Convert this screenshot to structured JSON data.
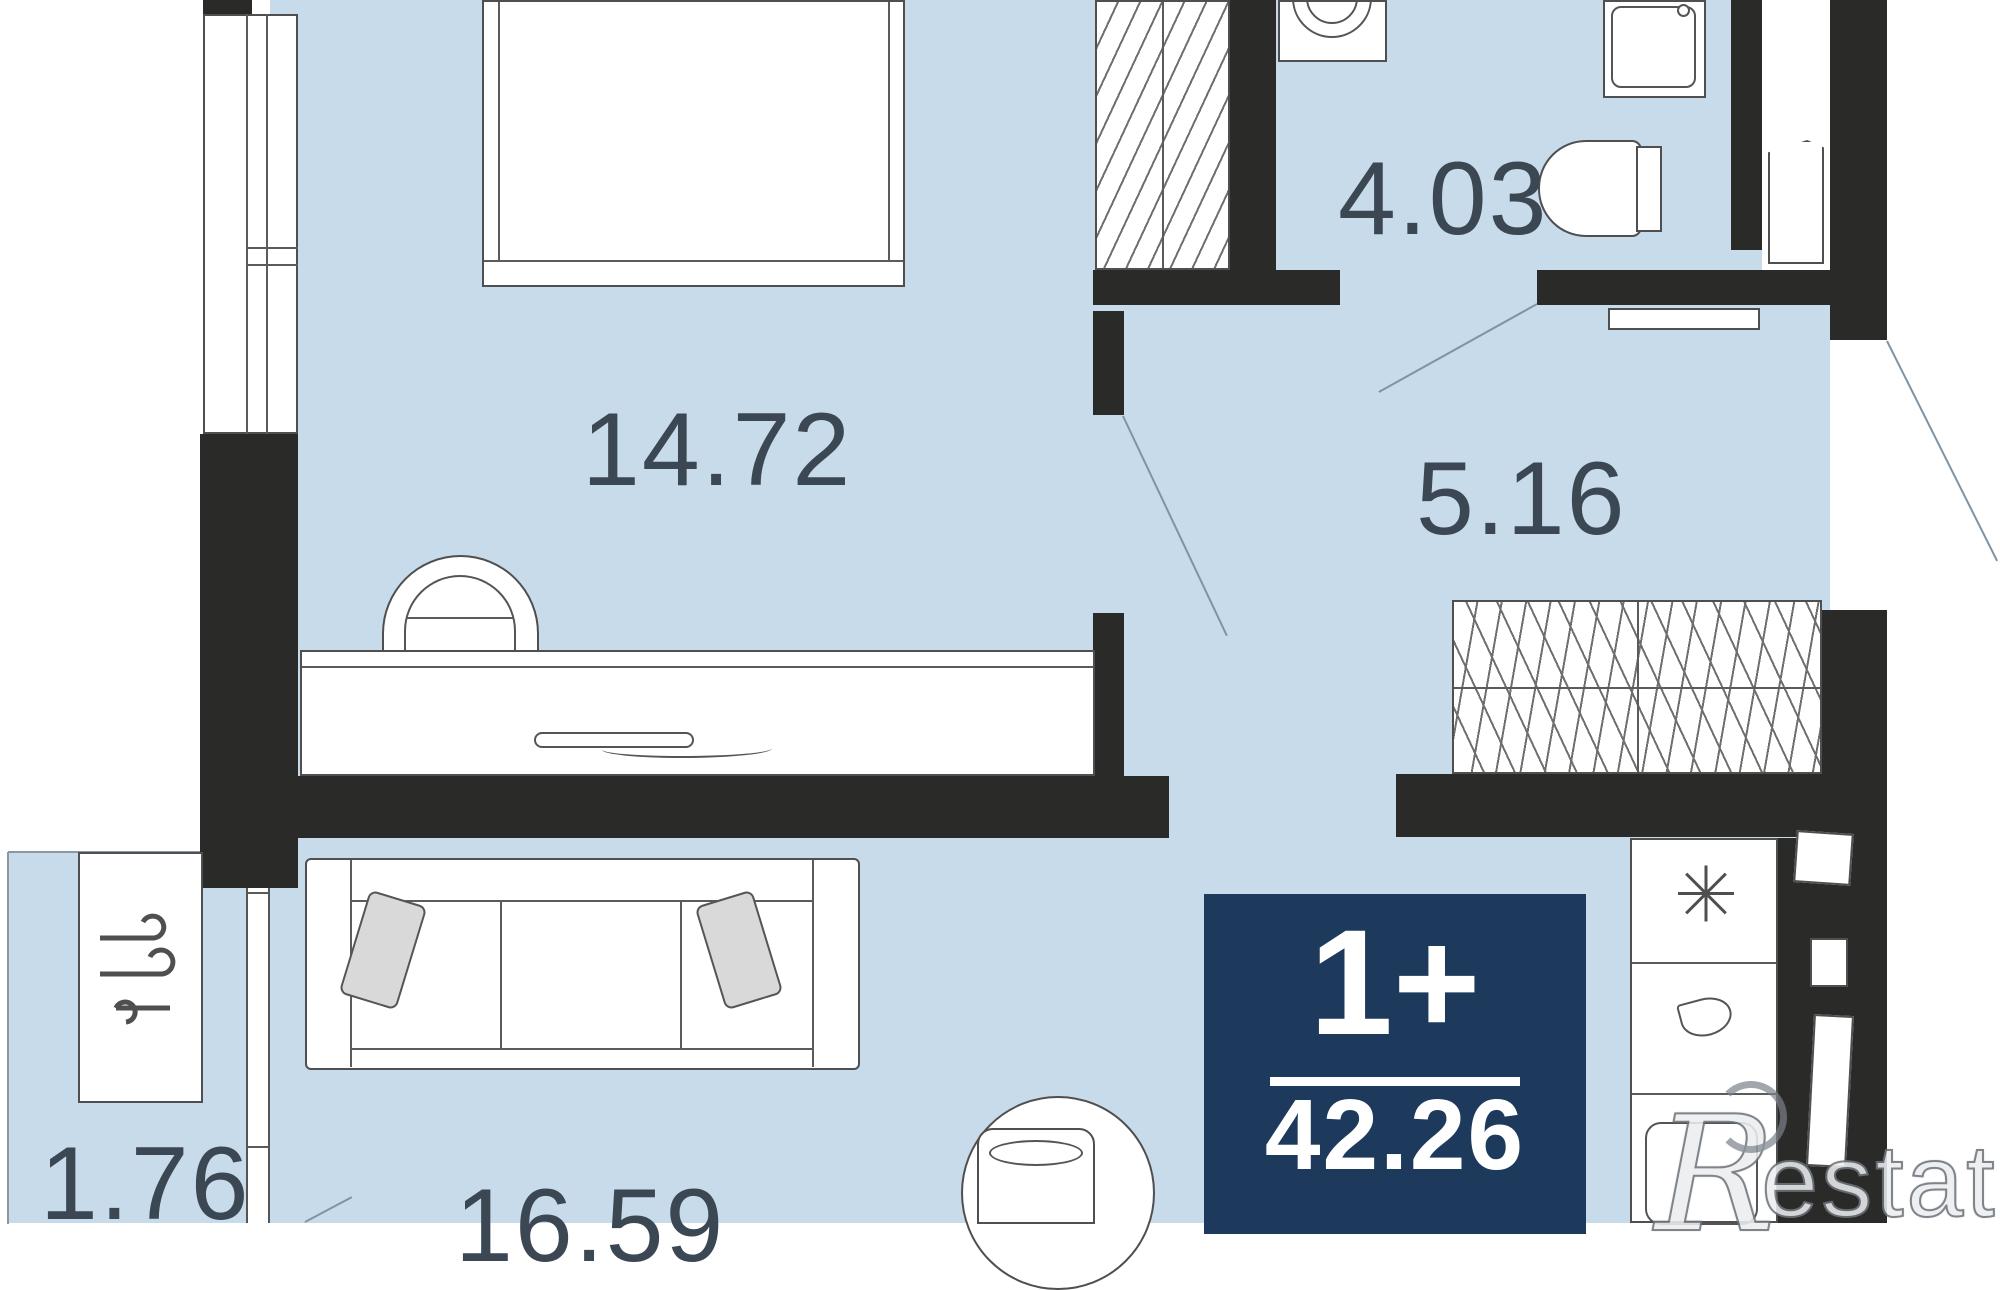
{
  "plan_title": "Apartment floor plan",
  "rooms": {
    "bedroom": {
      "area": "14.72"
    },
    "bathroom": {
      "area": "4.03"
    },
    "hallway": {
      "area": "5.16"
    },
    "balcony": {
      "area": "1.76"
    },
    "living_kitchen": {
      "area": "16.59"
    }
  },
  "badge": {
    "layout": "1+",
    "total_area": "42.26"
  },
  "watermark": {
    "initial": "R",
    "text": "estate"
  },
  "colors": {
    "floor": "#c8dbea",
    "wall": "#2a2a28",
    "badge_bg": "#1d3a5c",
    "label_text": "#3c4754",
    "door_line": "#7f93a3",
    "furniture_stroke": "#4f4f4f"
  },
  "icons": {
    "air_conditioner": "wind-icon",
    "fridge": "snowflake-asterisk-icon",
    "hob": "droplet-icon",
    "wardrobes": "hatch-pattern"
  }
}
